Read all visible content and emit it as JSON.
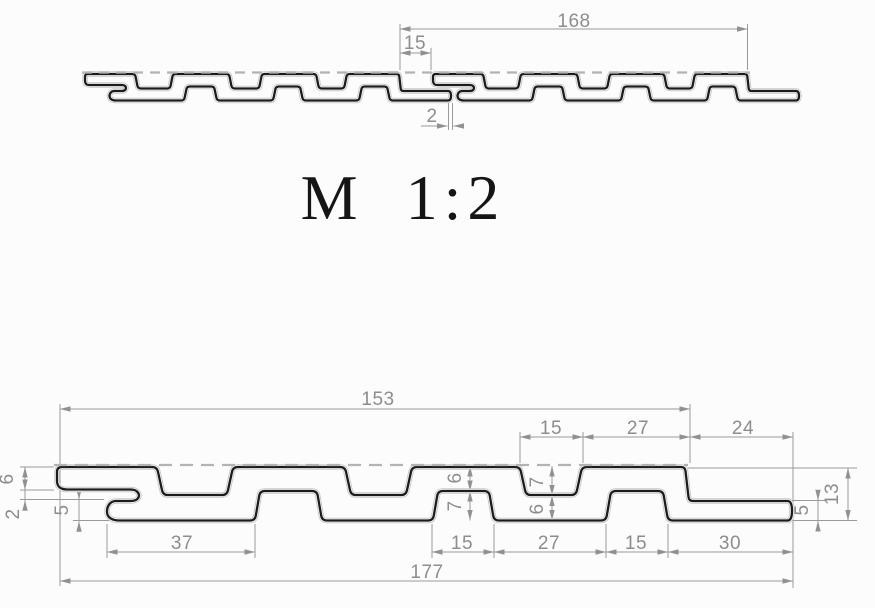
{
  "scale_label": "M 1:2",
  "top_view": {
    "pitch": "168",
    "tongue_overlap": "15",
    "seam_gap": "2"
  },
  "bottom_view": {
    "overall_top": "153",
    "overall_bottom": "177",
    "top_chain": {
      "groove_width": "15",
      "spacing": "27",
      "tongue_length": "24"
    },
    "bottom_chain": {
      "first_slat": "37",
      "slat_a": "15",
      "gap_a": "27",
      "slat_b": "15",
      "end_section": "30"
    },
    "left_stack": {
      "flange_height": "6",
      "slot_gap": "2",
      "lip_height": "5"
    },
    "mid_a": {
      "upper": "6",
      "lower": "7"
    },
    "mid_b": {
      "upper": "7",
      "lower": "6"
    },
    "right_stack": {
      "tongue_thickness": "5",
      "total_height": "13"
    }
  }
}
